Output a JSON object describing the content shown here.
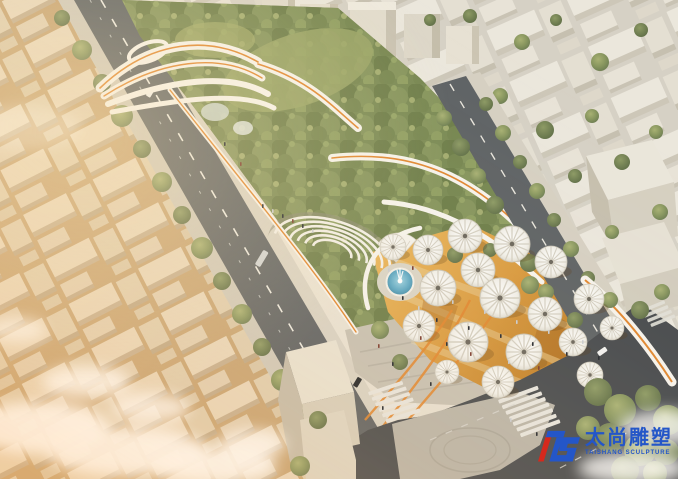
{
  "meta": {
    "description": "Aerial golden-hour architectural rendering of a linear urban park: white massing-model city blocks, tree-lined boulevard, elevated white ribbon walkways with orange stripes, stepped amphitheater, circular fountain pool, amber plaza covered by white radial umbrella canopies, street intersection with zebra crosswalks, low clouds over the rooftops"
  },
  "watermark": {
    "monogram": "TS",
    "brand_cn": "太尚雕塑",
    "brand_en": "TAISHANG SCULPTURE"
  },
  "palette": {
    "logo_blue": "#2456c8",
    "logo_red": "#d5291c",
    "asphalt": "#5e6264",
    "asphalt_dark": "#474a4d",
    "sidewalk": "#d0cabc",
    "block_top": "#e9e4d6",
    "block_side": "#c3bba8",
    "street_warm": "#c2a478",
    "park_green": "#7a8a54",
    "tree_dark": "#66754a",
    "tree_light": "#95a164",
    "plaza_amber": "#e0a64f",
    "plaza_deep": "#bb7a2b",
    "ribbon_white": "#f6f3ec",
    "ribbon_orange": "#e0862f",
    "fountain_blue": "#62adc6",
    "umbrella_white": "#f3f1ea",
    "cloud_white": "#ffffff",
    "paving_grey": "#c6c0b2"
  },
  "scene": {
    "umbrella_count": 18,
    "landmarks": [
      "left-city-blocks",
      "tree-lined-boulevard",
      "elevated-ribbon-walkways",
      "amphitheater",
      "fountain",
      "umbrella-plaza",
      "right-street",
      "intersection-crosswalks",
      "clouds",
      "right-city-blocks"
    ]
  }
}
